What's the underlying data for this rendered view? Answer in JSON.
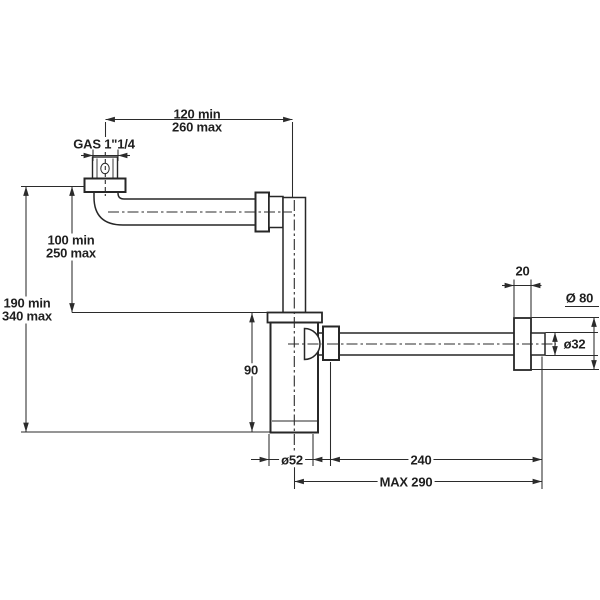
{
  "drawing": {
    "type": "technical-drawing",
    "subject": "bottle trap siphon with horizontal wall outlet, dimensioned side view",
    "units": "mm",
    "colors": {
      "background": "#ffffff",
      "line": "#2b2b2b",
      "text": "#1f1f1f",
      "fill": "#ffffff"
    },
    "dimensions": {
      "top_offset": {
        "line1": "120 min",
        "line2": "260 max"
      },
      "inlet_thread": "GAS 1\"1/4",
      "drop_height": {
        "line1": "100 min",
        "line2": "250 max"
      },
      "total_height": {
        "line1": "190 min",
        "line2": "340 max"
      },
      "body_height": "90",
      "body_diameter": "ø52",
      "outlet_length": "240",
      "max_reach": "MAX 290",
      "flange_thickness": "20",
      "flange_diameter": "Ø 80",
      "pipe_diameter": "ø32"
    }
  }
}
